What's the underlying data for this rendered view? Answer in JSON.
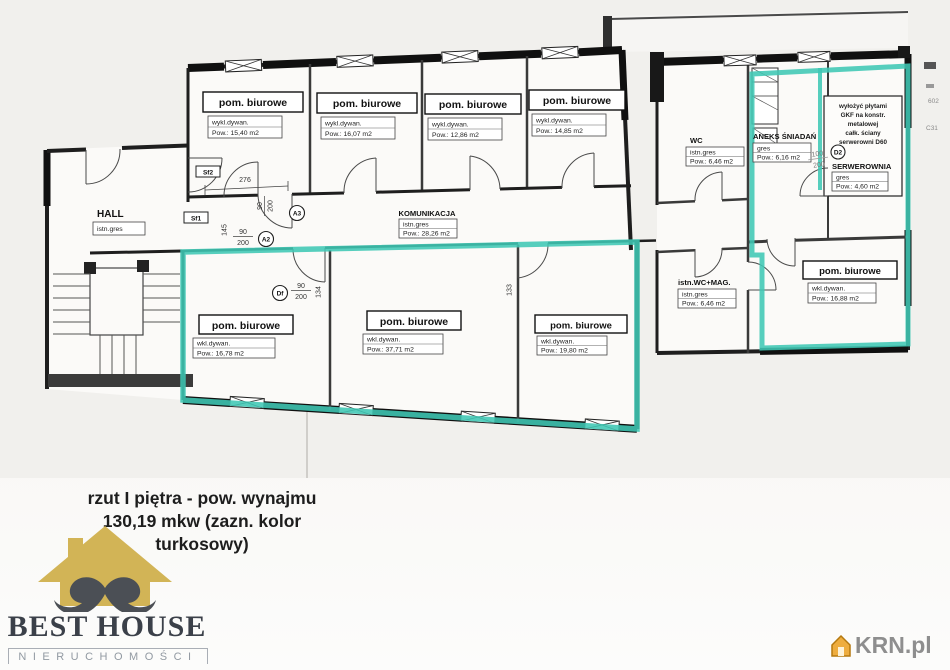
{
  "colors": {
    "highlight_teal": "#3fc7b4",
    "logo_gold": "#d2b456",
    "mustache_gray": "#4b4f55",
    "logo_text": "#3b4049",
    "watermark_gray": "#8e8e8e",
    "watermark_house_gold": "#eead3f"
  },
  "caption": {
    "line1": "rzut I piętra - pow. wynajmu",
    "line2": "130,19 mkw (zazn. kolor",
    "line3": "turkosowy)"
  },
  "logo": {
    "title": "BEST HOUSE",
    "subtitle": "NIERUCHOMOŚCI"
  },
  "watermark": {
    "text": "KRN.pl"
  },
  "plan": {
    "rooms": [
      {
        "name": "pom. biurowe",
        "material": "wykl.dywan.",
        "area": "Pow.: 15,40 m2"
      },
      {
        "name": "pom. biurowe",
        "material": "wykl.dywan.",
        "area": "Pow.: 16,07 m2"
      },
      {
        "name": "pom. biurowe",
        "material": "wykl.dywan.",
        "area": "Pow.: 12,86 m2"
      },
      {
        "name": "pom. biurowe",
        "material": "wykl.dywan.",
        "area": "Pow.: 14,85 m2"
      },
      {
        "name": "KOMUNIKACJA",
        "material": "istn.gres",
        "area": "Pow.: 28,26 m2"
      },
      {
        "name": "HALL",
        "material": "istn.gres",
        "area": ""
      },
      {
        "name": "WC",
        "material": "istn.gres",
        "area": "Pow.: 6,46 m2"
      },
      {
        "name": "ANEKS ŚNIADAŃ",
        "material": "gres",
        "area": "Pow.: 6,16 m2"
      },
      {
        "name": "SERWEROWNIA",
        "material": "gres",
        "area": "Pow.: 4,60 m2"
      },
      {
        "name": "istn.WC+MAG.",
        "material": "istn.gres",
        "area": "Pow.: 6,46 m2"
      },
      {
        "name": "pom. biurowe",
        "material": "wkl.dywan.",
        "area": "Pow.: 16,88 m2"
      },
      {
        "name": "pom. biurowe",
        "material": "wkl.dywan.",
        "area": "Pow.: 16,78 m2"
      },
      {
        "name": "pom. biurowe",
        "material": "wkl.dywan.",
        "area": "Pow.: 37,71 m2"
      },
      {
        "name": "pom. biurowe",
        "material": "wkl.dywan.",
        "area": "Pow.: 19,80 m2"
      }
    ],
    "note": {
      "lines": [
        "wyłożyć płytami",
        "GKF na konstr.",
        "metalowej",
        "całk. ściany",
        "serwerowni D60"
      ]
    },
    "markers": {
      "sf2": "Sf2",
      "sf1": "Sf1",
      "a3": "A3",
      "a2": "A2",
      "df": "Df",
      "d2": "D2"
    },
    "dims": {
      "d276": "276",
      "d90": "90",
      "d200": "200",
      "d100": "100",
      "d133": "133",
      "d134": "134",
      "d145": "145"
    },
    "artifacts": {
      "t1": "602",
      "t2": "C31"
    }
  }
}
